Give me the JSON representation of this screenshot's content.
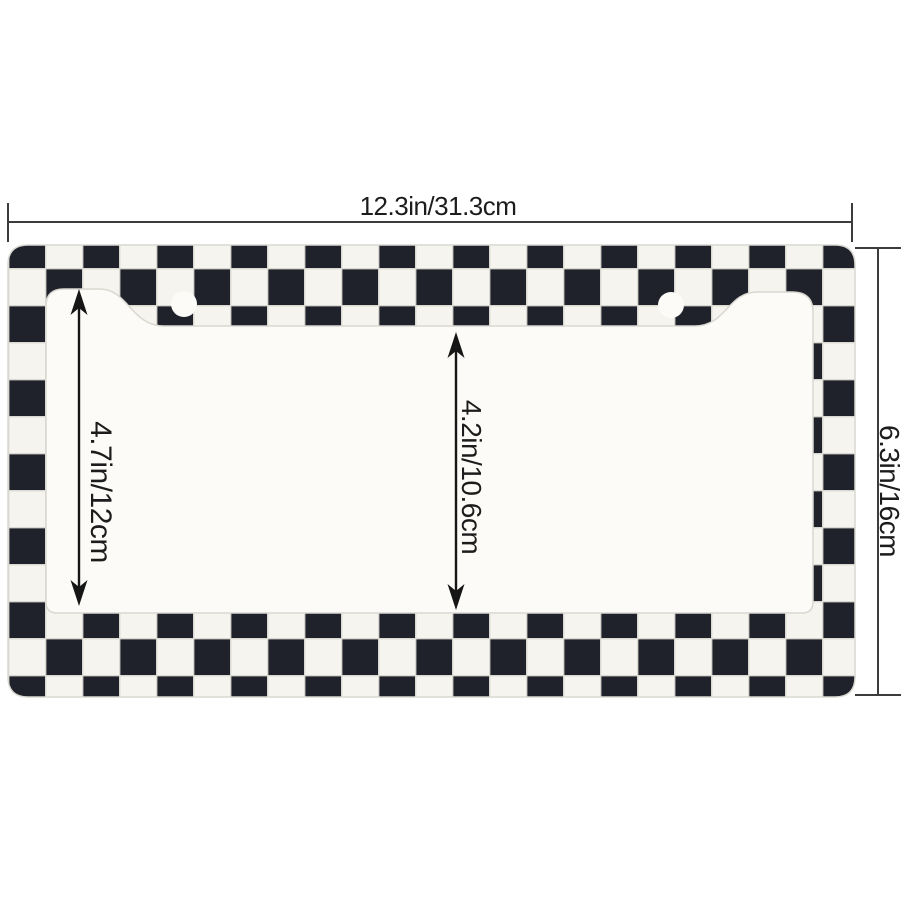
{
  "page": {
    "description": "Product dimension diagram of a black and white checkered license plate frame"
  },
  "frame": {
    "pattern": "checkerboard",
    "checker_black": "#20222b",
    "checker_white": "#f5f4ee",
    "seam_color": "#d9d8d1",
    "window_fill": "#fcfbf7",
    "screw_hole_count": 2
  },
  "annotation": {
    "line_color": "#3c3c3c",
    "arrow_color": "#161616"
  },
  "dimension_labels": {
    "outer_width": "12.3in/31.3cm",
    "outer_height": "6.3in/16cm",
    "inner_left_height": "4.7in/12cm",
    "inner_center_height": "4.2in/10.6cm"
  }
}
